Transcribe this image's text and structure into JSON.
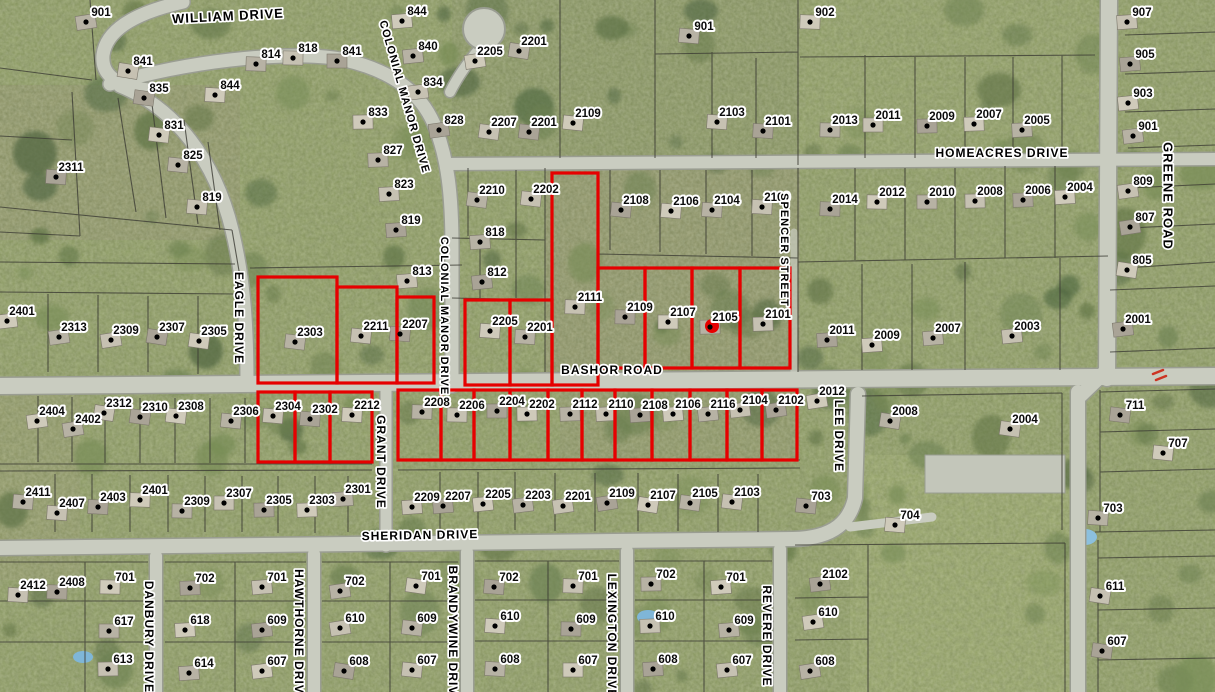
{
  "map": {
    "colors": {
      "highlight_red": "#e60000",
      "grass_base": "#8b9a60",
      "road_fill": "#c9ccc0",
      "road_casing": "#9a9d92",
      "parcel_line": "#3c3c34",
      "label_text": "#0a0a0a",
      "label_halo": "#ffffff",
      "tree_palette": [
        "#5d7244",
        "#6b8050",
        "#778c55",
        "#4f6540"
      ],
      "house_palette": [
        "#b7b2a4",
        "#c6c1b2",
        "#a9a396",
        "#cfcaba"
      ]
    },
    "streets": [
      {
        "name": "WILLIAM DRIVE",
        "x": 228,
        "y": 17,
        "rot": -3,
        "size": 13
      },
      {
        "name": "COLONIAL MANOR DRIVE",
        "x": 404,
        "y": 97,
        "rot": 74,
        "size": 11
      },
      {
        "name": "COLONIAL MANOR DRIVE",
        "x": 444,
        "y": 316,
        "rot": 90,
        "size": 11
      },
      {
        "name": "HOMEACRES DRIVE",
        "x": 1002,
        "y": 154,
        "rot": 0,
        "size": 12
      },
      {
        "name": "GREENE ROAD",
        "x": 1167,
        "y": 196,
        "rot": 90,
        "size": 13
      },
      {
        "name": "EAGLE DRIVE",
        "x": 238,
        "y": 318,
        "rot": 90,
        "size": 12
      },
      {
        "name": "SPENCER STREET",
        "x": 784,
        "y": 250,
        "rot": 90,
        "size": 11
      },
      {
        "name": "BASHOR ROAD",
        "x": 612,
        "y": 371,
        "rot": 0,
        "size": 12
      },
      {
        "name": "GRANT DRIVE",
        "x": 380,
        "y": 462,
        "rot": 90,
        "size": 12
      },
      {
        "name": "LEE DRIVE",
        "x": 838,
        "y": 436,
        "rot": 90,
        "size": 12
      },
      {
        "name": "SHERIDAN DRIVE",
        "x": 420,
        "y": 536,
        "rot": -1,
        "size": 12
      },
      {
        "name": "DANBURY DRIVE",
        "x": 148,
        "y": 637,
        "rot": 90,
        "size": 12
      },
      {
        "name": "HAWTHORNE DRIVE",
        "x": 298,
        "y": 636,
        "rot": 90,
        "size": 12
      },
      {
        "name": "BRANDYWINE DRIVE",
        "x": 452,
        "y": 635,
        "rot": 90,
        "size": 12
      },
      {
        "name": "LEXINGTON DRIVE",
        "x": 611,
        "y": 636,
        "rot": 90,
        "size": 12
      },
      {
        "name": "REVERE DRIVE",
        "x": 766,
        "y": 636,
        "rot": 90,
        "size": 12
      }
    ],
    "house_labels": [
      [
        "901",
        101,
        13
      ],
      [
        "841",
        143,
        62
      ],
      [
        "835",
        159,
        89
      ],
      [
        "831",
        174,
        126
      ],
      [
        "825",
        193,
        156
      ],
      [
        "819",
        212,
        198
      ],
      [
        "2311",
        71,
        168
      ],
      [
        "844",
        230,
        86
      ],
      [
        "814",
        271,
        55
      ],
      [
        "818",
        308,
        49
      ],
      [
        "841",
        352,
        52
      ],
      [
        "833",
        378,
        113
      ],
      [
        "827",
        393,
        151
      ],
      [
        "823",
        404,
        185
      ],
      [
        "819",
        411,
        221
      ],
      [
        "844",
        417,
        12
      ],
      [
        "840",
        428,
        47
      ],
      [
        "834",
        433,
        83
      ],
      [
        "828",
        454,
        121
      ],
      [
        "2205",
        490,
        52
      ],
      [
        "2201",
        534,
        42
      ],
      [
        "2207",
        504,
        123
      ],
      [
        "2201",
        544,
        123
      ],
      [
        "2109",
        588,
        114
      ],
      [
        "901",
        704,
        27
      ],
      [
        "2103",
        732,
        113
      ],
      [
        "2101",
        778,
        122
      ],
      [
        "902",
        825,
        13
      ],
      [
        "2013",
        845,
        121
      ],
      [
        "2011",
        888,
        116
      ],
      [
        "2009",
        942,
        117
      ],
      [
        "2007",
        989,
        115
      ],
      [
        "2005",
        1037,
        121
      ],
      [
        "907",
        1142,
        13
      ],
      [
        "905",
        1145,
        55
      ],
      [
        "903",
        1143,
        94
      ],
      [
        "901",
        1148,
        127
      ],
      [
        "809",
        1143,
        182
      ],
      [
        "807",
        1145,
        218
      ],
      [
        "805",
        1142,
        261
      ],
      [
        "2210",
        492,
        191
      ],
      [
        "2202",
        546,
        190
      ],
      [
        "2108",
        636,
        201
      ],
      [
        "2106",
        686,
        202
      ],
      [
        "2104",
        727,
        201
      ],
      [
        "2100",
        777,
        198
      ],
      [
        "2014",
        845,
        200
      ],
      [
        "2012",
        892,
        193
      ],
      [
        "2010",
        942,
        193
      ],
      [
        "2008",
        990,
        192
      ],
      [
        "2006",
        1038,
        191
      ],
      [
        "2004",
        1080,
        188
      ],
      [
        "818",
        495,
        233
      ],
      [
        "813",
        422,
        272
      ],
      [
        "812",
        497,
        273
      ],
      [
        "2401",
        22,
        312
      ],
      [
        "2313",
        74,
        328
      ],
      [
        "2309",
        126,
        331
      ],
      [
        "2307",
        172,
        328
      ],
      [
        "2305",
        214,
        332
      ],
      [
        "2303",
        310,
        333
      ],
      [
        "2211",
        376,
        327
      ],
      [
        "2207",
        415,
        325
      ],
      [
        "2205",
        505,
        322
      ],
      [
        "2201",
        540,
        328
      ],
      [
        "2111",
        590,
        298
      ],
      [
        "2109",
        640,
        308
      ],
      [
        "2107",
        683,
        313
      ],
      [
        "2105",
        725,
        318
      ],
      [
        "2101",
        778,
        315
      ],
      [
        "2011",
        842,
        331
      ],
      [
        "2009",
        887,
        336
      ],
      [
        "2007",
        948,
        329
      ],
      [
        "2003",
        1027,
        327
      ],
      [
        "2001",
        1138,
        320
      ],
      [
        "2404",
        52,
        412
      ],
      [
        "2402",
        88,
        420
      ],
      [
        "2312",
        119,
        404
      ],
      [
        "2310",
        155,
        408
      ],
      [
        "2308",
        191,
        407
      ],
      [
        "2306",
        246,
        412
      ],
      [
        "2304",
        288,
        407
      ],
      [
        "2302",
        325,
        410
      ],
      [
        "2212",
        367,
        406
      ],
      [
        "2208",
        437,
        403
      ],
      [
        "2206",
        472,
        406
      ],
      [
        "2204",
        512,
        402
      ],
      [
        "2202",
        542,
        405
      ],
      [
        "2112",
        585,
        405
      ],
      [
        "2110",
        621,
        405
      ],
      [
        "2108",
        655,
        406
      ],
      [
        "2106",
        688,
        405
      ],
      [
        "2116",
        723,
        405
      ],
      [
        "2104",
        755,
        401
      ],
      [
        "2102",
        791,
        401
      ],
      [
        "2012",
        832,
        392
      ],
      [
        "2008",
        905,
        412
      ],
      [
        "2004",
        1025,
        420
      ],
      [
        "711",
        1135,
        406
      ],
      [
        "707",
        1178,
        444
      ],
      [
        "2411",
        38,
        493
      ],
      [
        "2407",
        72,
        504
      ],
      [
        "2403",
        113,
        498
      ],
      [
        "2401",
        155,
        491
      ],
      [
        "2309",
        197,
        502
      ],
      [
        "2307",
        239,
        494
      ],
      [
        "2305",
        279,
        501
      ],
      [
        "2303",
        322,
        501
      ],
      [
        "2301",
        358,
        490
      ],
      [
        "2209",
        427,
        498
      ],
      [
        "2207",
        458,
        497
      ],
      [
        "2205",
        498,
        495
      ],
      [
        "2203",
        538,
        496
      ],
      [
        "2201",
        578,
        497
      ],
      [
        "2109",
        622,
        494
      ],
      [
        "2107",
        663,
        496
      ],
      [
        "2105",
        705,
        494
      ],
      [
        "2103",
        747,
        493
      ],
      [
        "703",
        821,
        497
      ],
      [
        "704",
        910,
        516
      ],
      [
        "703",
        1113,
        509
      ],
      [
        "2412",
        33,
        586
      ],
      [
        "2408",
        72,
        583
      ],
      [
        "701",
        125,
        578
      ],
      [
        "617",
        124,
        622
      ],
      [
        "613",
        123,
        660
      ],
      [
        "702",
        205,
        579
      ],
      [
        "618",
        200,
        621
      ],
      [
        "614",
        204,
        664
      ],
      [
        "701",
        277,
        578
      ],
      [
        "609",
        277,
        621
      ],
      [
        "607",
        277,
        662
      ],
      [
        "702",
        355,
        582
      ],
      [
        "610",
        355,
        619
      ],
      [
        "608",
        359,
        662
      ],
      [
        "701",
        431,
        577
      ],
      [
        "609",
        427,
        619
      ],
      [
        "607",
        427,
        661
      ],
      [
        "702",
        509,
        578
      ],
      [
        "610",
        510,
        617
      ],
      [
        "608",
        510,
        660
      ],
      [
        "701",
        588,
        577
      ],
      [
        "609",
        586,
        620
      ],
      [
        "607",
        588,
        661
      ],
      [
        "702",
        666,
        575
      ],
      [
        "610",
        665,
        617
      ],
      [
        "608",
        668,
        660
      ],
      [
        "701",
        736,
        578
      ],
      [
        "609",
        744,
        621
      ],
      [
        "607",
        742,
        661
      ],
      [
        "2102",
        835,
        575
      ],
      [
        "610",
        828,
        613
      ],
      [
        "608",
        825,
        662
      ],
      [
        "611",
        1115,
        587
      ],
      [
        "607",
        1117,
        642
      ]
    ],
    "highlighted_parcels": [
      {
        "x": 258,
        "y": 277,
        "w": 79,
        "h": 106
      },
      {
        "x": 337,
        "y": 287,
        "w": 60,
        "h": 96
      },
      {
        "x": 397,
        "y": 297,
        "w": 37,
        "h": 86
      },
      {
        "x": 465,
        "y": 300,
        "w": 45,
        "h": 85
      },
      {
        "x": 510,
        "y": 300,
        "w": 42,
        "h": 85
      },
      {
        "x": 552,
        "y": 173,
        "w": 46,
        "h": 212
      },
      {
        "x": 598,
        "y": 268,
        "w": 47,
        "h": 100
      },
      {
        "x": 645,
        "y": 268,
        "w": 47,
        "h": 100
      },
      {
        "x": 692,
        "y": 268,
        "w": 48,
        "h": 100
      },
      {
        "x": 740,
        "y": 268,
        "w": 50,
        "h": 100
      },
      {
        "x": 258,
        "y": 392,
        "w": 37,
        "h": 70
      },
      {
        "x": 295,
        "y": 392,
        "w": 35,
        "h": 70
      },
      {
        "x": 330,
        "y": 392,
        "w": 42,
        "h": 70
      },
      {
        "x": 398,
        "y": 390,
        "w": 43,
        "h": 70
      },
      {
        "x": 441,
        "y": 390,
        "w": 33,
        "h": 70
      },
      {
        "x": 474,
        "y": 390,
        "w": 36,
        "h": 70
      },
      {
        "x": 510,
        "y": 390,
        "w": 38,
        "h": 70
      },
      {
        "x": 548,
        "y": 390,
        "w": 34,
        "h": 70
      },
      {
        "x": 582,
        "y": 390,
        "w": 33,
        "h": 70
      },
      {
        "x": 615,
        "y": 390,
        "w": 37,
        "h": 70
      },
      {
        "x": 652,
        "y": 390,
        "w": 38,
        "h": 70
      },
      {
        "x": 690,
        "y": 390,
        "w": 37,
        "h": 70
      },
      {
        "x": 727,
        "y": 390,
        "w": 35,
        "h": 70
      },
      {
        "x": 762,
        "y": 390,
        "w": 35,
        "h": 70
      }
    ],
    "selected_point": {
      "x": 712,
      "y": 326,
      "r": 7
    }
  }
}
